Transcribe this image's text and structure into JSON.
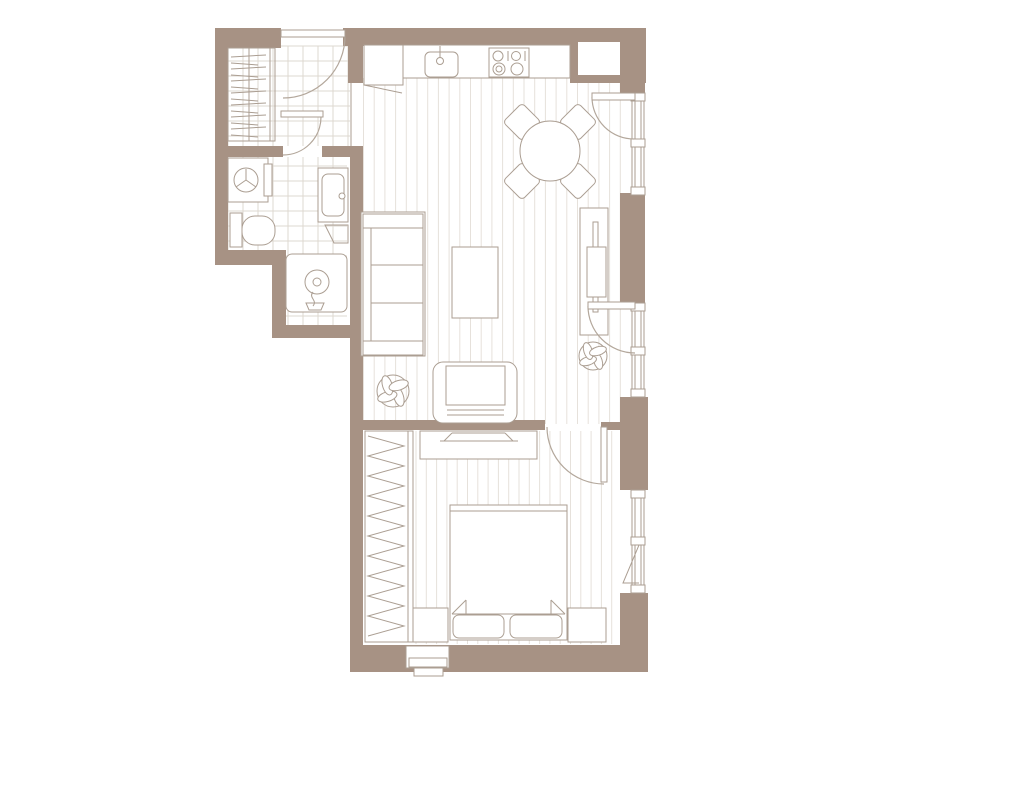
{
  "canvas": {
    "width": 1011,
    "height": 800,
    "background": "#ffffff"
  },
  "palette": {
    "wall": "#a79284",
    "line": "#ab9e92",
    "floor_line": "#e6e1db",
    "tile_line": "#ded8d1",
    "arc": "#b3a79b",
    "white": "#ffffff"
  },
  "floors": {
    "grid_origin": [
      228,
      46
    ],
    "tile_size": 15,
    "tiles": [
      {
        "n": "floor-hallway",
        "x": 228,
        "y": 46,
        "w": 122,
        "h": 100
      },
      {
        "n": "floor-bathroom-upper",
        "x": 228,
        "y": 157,
        "w": 119,
        "h": 93
      },
      {
        "n": "floor-bathroom-lower",
        "x": 286,
        "y": 250,
        "w": 61,
        "h": 75
      }
    ],
    "planks": [
      {
        "n": "floor-living-kitchen",
        "x0": 363.5,
        "x1": 629,
        "step": 10.7,
        "y0": 78,
        "y1": 424
      },
      {
        "n": "floor-bedroom",
        "x0": 416,
        "x1": 616,
        "step": 10.3,
        "y0": 431,
        "y1": 644
      }
    ]
  },
  "walls": [
    {
      "n": "wall-top-left",
      "x": 215,
      "y": 28,
      "w": 66,
      "h": 20
    },
    {
      "n": "wall-top-middle",
      "x": 343,
      "y": 28,
      "w": 227,
      "h": 18
    },
    {
      "n": "wall-top-right-block",
      "x": 570,
      "y": 28,
      "w": 76,
      "h": 55
    },
    {
      "n": "wall-kitchen-stub",
      "x": 348,
      "y": 46,
      "w": 15,
      "h": 37
    },
    {
      "n": "wall-left",
      "x": 215,
      "y": 46,
      "w": 13,
      "h": 219
    },
    {
      "n": "wall-bath-south-left",
      "x": 215,
      "y": 250,
      "w": 63,
      "h": 15
    },
    {
      "n": "wall-bath-step",
      "x": 272,
      "y": 250,
      "w": 14,
      "h": 88
    },
    {
      "n": "wall-bath-south",
      "x": 272,
      "y": 325,
      "w": 80,
      "h": 13
    },
    {
      "n": "wall-hall-bath-west",
      "x": 215,
      "y": 146,
      "w": 68,
      "h": 11
    },
    {
      "n": "wall-hall-bath-east",
      "x": 322,
      "y": 146,
      "w": 40,
      "h": 11
    },
    {
      "n": "wall-west",
      "x": 350,
      "y": 146,
      "w": 13,
      "h": 526
    },
    {
      "n": "wall-living-bedroom",
      "x": 358,
      "y": 420,
      "w": 187,
      "h": 10
    },
    {
      "n": "wall-bedroom-door-stub",
      "x": 601,
      "y": 422,
      "w": 19,
      "h": 8
    },
    {
      "n": "wall-right-top",
      "x": 620,
      "y": 83,
      "w": 25,
      "h": 15
    },
    {
      "n": "wall-right-pier-1",
      "x": 620,
      "y": 193,
      "w": 25,
      "h": 110
    },
    {
      "n": "wall-right-pier-2",
      "x": 620,
      "y": 397,
      "w": 28,
      "h": 93
    },
    {
      "n": "wall-right-bottom",
      "x": 620,
      "y": 593,
      "w": 28,
      "h": 79
    },
    {
      "n": "wall-bottom",
      "x": 352,
      "y": 645,
      "w": 296,
      "h": 27
    }
  ],
  "white_rects": [
    {
      "n": "shaft-niche",
      "x": 578,
      "y": 42,
      "w": 42,
      "h": 33
    }
  ],
  "windows": {
    "block_h": 8,
    "items": [
      {
        "n": "window-living-top",
        "x": 632,
        "w": 12,
        "y": 93,
        "h": 102,
        "blocks": [
          93,
          139,
          187
        ]
      },
      {
        "n": "window-living-middle",
        "x": 632,
        "w": 12,
        "y": 303,
        "h": 94,
        "blocks": [
          303,
          347,
          389
        ]
      },
      {
        "n": "window-bedroom",
        "x": 632,
        "w": 12,
        "y": 490,
        "h": 103,
        "blocks": [
          490,
          537,
          585
        ],
        "tilt": "M639,545 L623,583 L639,583"
      }
    ]
  },
  "doors": [
    {
      "n": "door-entry",
      "leaf": [
        281,
        30,
        64,
        7
      ],
      "arc": "M345,36 A62,62 0 0 1 283,98"
    },
    {
      "n": "door-bathroom",
      "leaf": [
        281,
        111,
        42,
        6
      ],
      "arc": "M321,117 A38,38 0 0 1 283,155"
    },
    {
      "n": "door-balcony-top",
      "leaf": [
        592,
        93,
        43,
        7
      ],
      "arc": "M592,97 A42,42 0 0 0 634,139"
    },
    {
      "n": "door-balcony-middle",
      "leaf": [
        588,
        302,
        47,
        7
      ],
      "arc": "M588,306 A47,47 0 0 0 635,353"
    },
    {
      "n": "door-bedroom",
      "leaf": [
        601,
        427,
        6,
        55
      ],
      "arc": "M547,427 A57,57 0 0 0 604,484"
    }
  ],
  "furniture_rects": [
    {
      "n": "kitchen-counter",
      "x": 364,
      "y": 45,
      "w": 206,
      "h": 33
    },
    {
      "n": "kitchen-counter-end",
      "x": 364,
      "y": 45,
      "w": 39,
      "h": 40
    },
    {
      "n": "kitchen-sink",
      "x": 425,
      "y": 52,
      "w": 33,
      "h": 25,
      "rx": 5
    },
    {
      "n": "stove",
      "x": 489,
      "y": 48,
      "w": 40,
      "h": 29
    },
    {
      "n": "sofa-body",
      "x": 361,
      "y": 212,
      "w": 64,
      "h": 144
    },
    {
      "n": "sofa-armrest-top",
      "x": 363,
      "y": 214,
      "w": 60,
      "h": 14
    },
    {
      "n": "sofa-armrest-bottom",
      "x": 363,
      "y": 341,
      "w": 60,
      "h": 14
    },
    {
      "n": "sofa-back",
      "x": 363,
      "y": 228,
      "w": 8,
      "h": 113
    },
    {
      "n": "sofa-seat-1",
      "x": 371,
      "y": 228,
      "w": 52,
      "h": 37
    },
    {
      "n": "sofa-seat-2",
      "x": 371,
      "y": 265,
      "w": 52,
      "h": 38
    },
    {
      "n": "sofa-seat-3",
      "x": 371,
      "y": 303,
      "w": 52,
      "h": 38
    },
    {
      "n": "coffee-table",
      "x": 452,
      "y": 247,
      "w": 46,
      "h": 71
    },
    {
      "n": "armchair-body",
      "x": 433,
      "y": 362,
      "w": 84,
      "h": 61,
      "rx": 10
    },
    {
      "n": "armchair-seat",
      "x": 446,
      "y": 366,
      "w": 59,
      "h": 39
    },
    {
      "n": "console-desk",
      "x": 580,
      "y": 208,
      "w": 28,
      "h": 127
    },
    {
      "n": "console-desk-board",
      "x": 593,
      "y": 222,
      "w": 5,
      "h": 90
    },
    {
      "n": "console-desk-inner",
      "x": 587,
      "y": 247,
      "w": 19,
      "h": 50
    },
    {
      "n": "tv-dresser",
      "x": 420,
      "y": 431,
      "w": 117,
      "h": 28
    },
    {
      "n": "bed",
      "x": 450,
      "y": 505,
      "w": 117,
      "h": 135
    },
    {
      "n": "pillow-left",
      "x": 453,
      "y": 615,
      "w": 51,
      "h": 23,
      "rx": 6
    },
    {
      "n": "pillow-right",
      "x": 510,
      "y": 615,
      "w": 52,
      "h": 23,
      "rx": 6
    },
    {
      "n": "nightstand-left",
      "x": 412,
      "y": 608,
      "w": 36,
      "h": 34
    },
    {
      "n": "nightstand-right",
      "x": 568,
      "y": 608,
      "w": 38,
      "h": 34
    },
    {
      "n": "wardrobe-bedroom",
      "x": 365,
      "y": 431,
      "w": 48,
      "h": 211
    },
    {
      "n": "washing-machine",
      "x": 228,
      "y": 158,
      "w": 40,
      "h": 44
    },
    {
      "n": "washing-machine-panel",
      "x": 264,
      "y": 164,
      "w": 8,
      "h": 32
    },
    {
      "n": "toilet-tank",
      "x": 230,
      "y": 213,
      "w": 12,
      "h": 34
    },
    {
      "n": "toilet-bowl",
      "x": 242,
      "y": 216,
      "w": 33,
      "h": 29,
      "rx": 13
    },
    {
      "n": "vanity",
      "x": 318,
      "y": 168,
      "w": 30,
      "h": 54
    },
    {
      "n": "vanity-basin",
      "x": 322,
      "y": 174,
      "w": 22,
      "h": 42,
      "rx": 6
    },
    {
      "n": "shower-tray",
      "x": 286,
      "y": 254,
      "w": 61,
      "h": 58,
      "rx": 6
    },
    {
      "n": "ac-unit",
      "x": 406,
      "y": 646,
      "w": 43,
      "h": 22
    },
    {
      "n": "ac-unit-mid",
      "x": 409,
      "y": 658,
      "w": 38,
      "h": 9
    },
    {
      "n": "ac-unit-low",
      "x": 414,
      "y": 668,
      "w": 29,
      "h": 8
    },
    {
      "n": "closet-hall",
      "x": 228,
      "y": 48,
      "w": 47,
      "h": 93,
      "nf": true
    }
  ],
  "chairs": {
    "size": 27,
    "rx": 4,
    "items": [
      {
        "n": "dining-chair-nw",
        "cx": 522,
        "cy": 122
      },
      {
        "n": "dining-chair-ne",
        "cx": 578,
        "cy": 122
      },
      {
        "n": "dining-chair-sw",
        "cx": 522,
        "cy": 181
      },
      {
        "n": "dining-chair-se",
        "cx": 578,
        "cy": 181
      }
    ]
  },
  "circles": [
    {
      "n": "dining-table",
      "cx": 550,
      "cy": 151,
      "r": 30
    },
    {
      "n": "washing-machine-drum",
      "cx": 246,
      "cy": 180,
      "r": 12
    },
    {
      "n": "shower-drain",
      "cx": 317,
      "cy": 282,
      "r": 12
    },
    {
      "n": "shower-drain-center",
      "cx": 317,
      "cy": 282,
      "r": 4
    },
    {
      "n": "kitchen-faucet",
      "cx": 440,
      "cy": 61,
      "r": 3.5
    },
    {
      "n": "vanity-faucet",
      "cx": 342,
      "cy": 196,
      "r": 3
    },
    {
      "n": "burner-1",
      "cx": 498,
      "cy": 56,
      "r": 5
    },
    {
      "n": "burner-2",
      "cx": 516,
      "cy": 56,
      "r": 4.5
    },
    {
      "n": "burner-3",
      "cx": 499,
      "cy": 69,
      "r": 6
    },
    {
      "n": "burner-3-inner",
      "cx": 499,
      "cy": 69,
      "r": 3
    },
    {
      "n": "burner-4",
      "cx": 517,
      "cy": 69,
      "r": 6
    }
  ],
  "lines": [
    {
      "n": "counter-diagonal",
      "p": [
        364,
        85,
        402,
        93
      ]
    },
    {
      "n": "stove-bracket-left",
      "p": [
        508,
        51,
        508,
        61
      ]
    },
    {
      "n": "stove-bracket-right",
      "p": [
        525,
        51,
        525,
        61
      ]
    },
    {
      "n": "kitchen-faucet-stem",
      "p": [
        440,
        46,
        440,
        58
      ]
    },
    {
      "n": "washer-spoke-1",
      "p": [
        246,
        180,
        246,
        169
      ]
    },
    {
      "n": "washer-spoke-2",
      "p": [
        246,
        180,
        236,
        187
      ]
    },
    {
      "n": "washer-spoke-3",
      "p": [
        246,
        180,
        256,
        187
      ]
    },
    {
      "n": "tv-base",
      "p": [
        440,
        441,
        518,
        441
      ]
    },
    {
      "n": "tv-screen",
      "p": [
        452,
        433,
        505,
        433
      ]
    },
    {
      "n": "tv-edge-left",
      "p": [
        452,
        433,
        444,
        441
      ]
    },
    {
      "n": "tv-edge-right",
      "p": [
        505,
        433,
        513,
        441
      ]
    },
    {
      "n": "bed-blanket-top",
      "p": [
        450,
        511,
        567,
        511
      ]
    },
    {
      "n": "bed-blanket-edge",
      "p": [
        452,
        614,
        565,
        614
      ]
    },
    {
      "n": "blanket-fold-left-a",
      "p": [
        452,
        614,
        466,
        600
      ]
    },
    {
      "n": "blanket-fold-left-b",
      "p": [
        466,
        600,
        466,
        614
      ]
    },
    {
      "n": "blanket-fold-right-a",
      "p": [
        565,
        614,
        551,
        600
      ]
    },
    {
      "n": "blanket-fold-right-b",
      "p": [
        551,
        600,
        551,
        614
      ]
    },
    {
      "n": "armchair-back-line-1",
      "p": [
        447,
        405,
        504,
        405
      ]
    },
    {
      "n": "armchair-back-line-2",
      "p": [
        447,
        410,
        504,
        410
      ]
    },
    {
      "n": "armchair-back-line-3",
      "p": [
        447,
        415,
        504,
        415
      ]
    },
    {
      "n": "closet-rail",
      "p": [
        249,
        48,
        249,
        141
      ]
    },
    {
      "n": "closet-front-a",
      "p": [
        270,
        48,
        270,
        141
      ]
    },
    {
      "n": "closet-front-b",
      "p": [
        275,
        48,
        275,
        141
      ]
    },
    {
      "n": "wardrobe-front",
      "p": [
        408,
        431,
        408,
        642
      ]
    },
    {
      "n": "floor-transition",
      "p": [
        351,
        83,
        351,
        146
      ]
    }
  ],
  "paths": [
    {
      "n": "vanity-shelf",
      "d": "M325,225 L348,225 L348,243 L334,243 Z"
    },
    {
      "n": "shower-head",
      "d": "M313,292 C308,298 318,300 313,306 M306,303 L324,303 L321,310 L309,310 Z"
    }
  ],
  "zigzag": {
    "n": "wardrobe-hangers",
    "x1": 368,
    "x2": 404,
    "y0": 436,
    "y1": 638,
    "step": 10
  },
  "hatch": {
    "n": "closet-hangers",
    "x1": 231,
    "x2": 266,
    "y0": 57,
    "y1": 137,
    "step": 6
  },
  "plants": [
    {
      "n": "plant-living-room",
      "cx": 393,
      "cy": 391,
      "r": 16
    },
    {
      "n": "plant-by-window",
      "cx": 593,
      "cy": 356,
      "r": 14
    }
  ]
}
